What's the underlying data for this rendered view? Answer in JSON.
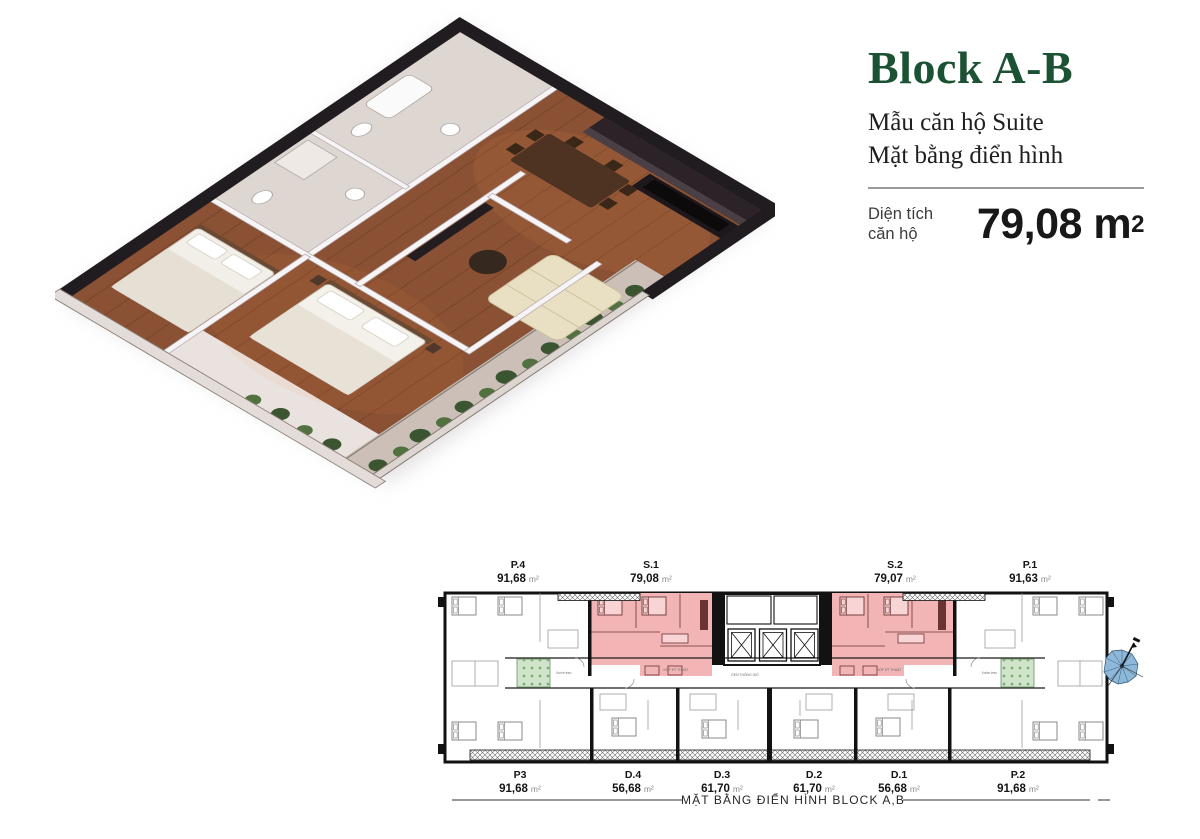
{
  "header": {
    "title": "Block A-B",
    "title_color": "#1b5233",
    "subtitle_line1": "Mẫu căn hộ Suite",
    "subtitle_line2": "Mặt bằng điển hình",
    "area_label_line1": "Diện tích",
    "area_label_line2": "căn hộ",
    "area_value": "79,08",
    "area_unit": "m",
    "area_unit_sup": "2"
  },
  "floorplan": {
    "caption": "MẶT BẰNG ĐIỂN HÌNH BLOCK A,B",
    "unit_suffix": "m²",
    "top_units": [
      {
        "id": "P.4",
        "area": "91,68"
      },
      {
        "id": "S.1",
        "area": "79,08",
        "highlighted": true
      },
      {
        "id": "S.2",
        "area": "79,07",
        "highlighted": true
      },
      {
        "id": "P.1",
        "area": "91,63"
      }
    ],
    "bottom_units": [
      {
        "id": "P3",
        "area": "91,68"
      },
      {
        "id": "D.4",
        "area": "56,68"
      },
      {
        "id": "D.3",
        "area": "61,70"
      },
      {
        "id": "D.2",
        "area": "61,70"
      },
      {
        "id": "D.1",
        "area": "56,68"
      },
      {
        "id": "P.2",
        "area": "91,68"
      }
    ],
    "micro_labels": {
      "technical_box_1": "HỘP KỸ THUẬT",
      "technical_box_2": "HỘP KỸ THUẬT",
      "vent_core": "GEN THÔNG GIÓ",
      "garden_left": "Vườn treo",
      "garden_right": "Vườn treo"
    },
    "colors": {
      "highlight": "#f2b4b4",
      "garden": "#cfe4c9"
    }
  },
  "icons": {
    "compass": "compass-rose"
  }
}
